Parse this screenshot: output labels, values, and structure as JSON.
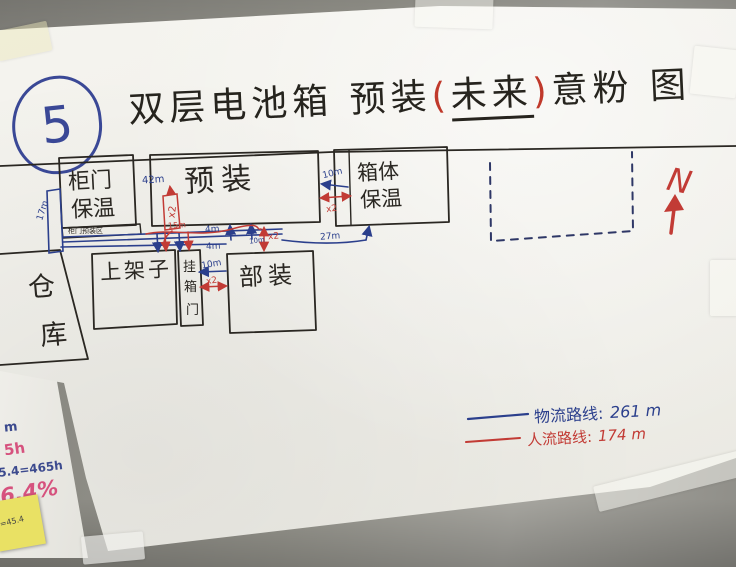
{
  "badge": {
    "number": "5"
  },
  "title": {
    "prefix": "双层电池箱 预装",
    "paren_open": "(",
    "highlight": "未来",
    "paren_close": ")",
    "suffix": "意粉 图"
  },
  "rooms": {
    "cangku_char1": "仓",
    "cangku_char2": "库",
    "guimen_line1": "柜门",
    "guimen_line2": "保温",
    "guimen_strip": "柜门预装区",
    "yuzhuang": "预装",
    "xiangti_line1": "箱体",
    "xiangti_line2": "保温",
    "shangjiazi": "上架子",
    "guamen_char1": "挂",
    "guamen_char2": "箱",
    "guamen_char3": "门",
    "buzhuang": "部装"
  },
  "measures": {
    "m17": "17m",
    "m42": "42m",
    "m15": "15m",
    "m4_upper": "4m",
    "m4_lower": "4m",
    "m10_gap": "10m",
    "m10_mid": "10m",
    "m10_lower": "10m",
    "m27": "27m",
    "x2": "x2"
  },
  "legend": {
    "logistics_label": "物流路线:",
    "logistics_value": "261 m",
    "people_label": "人流路线:",
    "people_value": "174 m"
  },
  "compass": {
    "north_label": "N"
  },
  "side_notes": {
    "note_m": "m",
    "note_5h": "5h",
    "note_eq": "5.4=465h",
    "note_pct": "6.4%",
    "sticky": "=45.4"
  },
  "colors": {
    "logistics_blue": "#2b3f8c",
    "people_red": "#c23b35",
    "ink": "#2a2722"
  }
}
